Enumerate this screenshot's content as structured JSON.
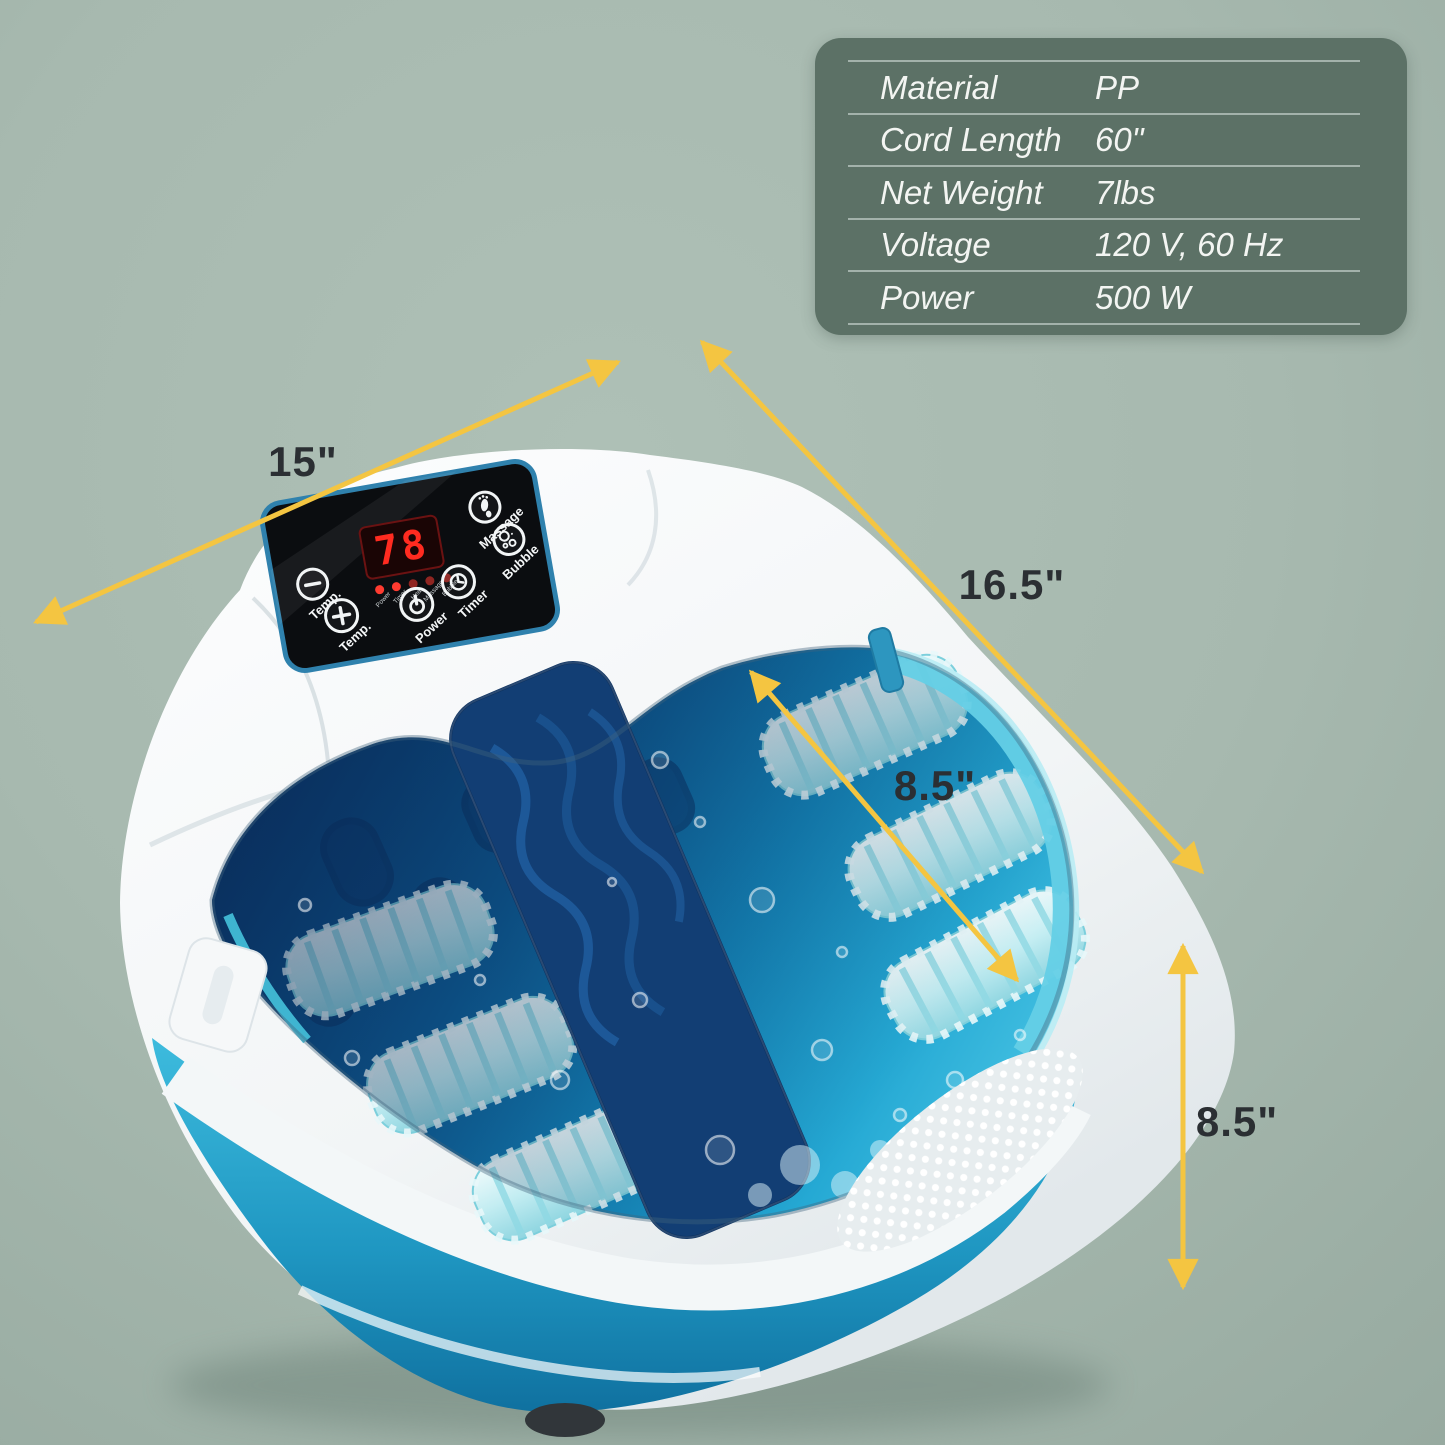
{
  "specs": {
    "rows": [
      {
        "label": "Material",
        "value": "PP"
      },
      {
        "label": "Cord Length",
        "value": "60\""
      },
      {
        "label": "Net Weight",
        "value": "7lbs"
      },
      {
        "label": "Voltage",
        "value": "120 V, 60 Hz"
      },
      {
        "label": "Power",
        "value": "500 W"
      }
    ]
  },
  "dimensions": {
    "top_width": "15\"",
    "diagonal_depth": "16.5\"",
    "inner_width": "8.5\"",
    "height": "8.5\""
  },
  "panel": {
    "display_value": "78",
    "indicator_labels": [
      "Power",
      "Timer",
      "Heat",
      "Massage",
      "Bubble"
    ],
    "buttons": {
      "temp_minus": "Temp.",
      "temp_plus": "Temp.",
      "power": "Power",
      "timer": "Timer",
      "massage": "Massage",
      "bubble": "Bubble"
    }
  },
  "colors": {
    "background": "#a7b9af",
    "table_background": "#5c7166",
    "arrow_yellow": "#f4c541",
    "dimension_text": "#2b2f33",
    "bucket_blue": "#2bacd2",
    "water_deep_blue": "#0b3b71",
    "water_teal": "#25a9d4",
    "panel_border_blue": "#2f81ad",
    "led_red": "#ff2b20"
  }
}
